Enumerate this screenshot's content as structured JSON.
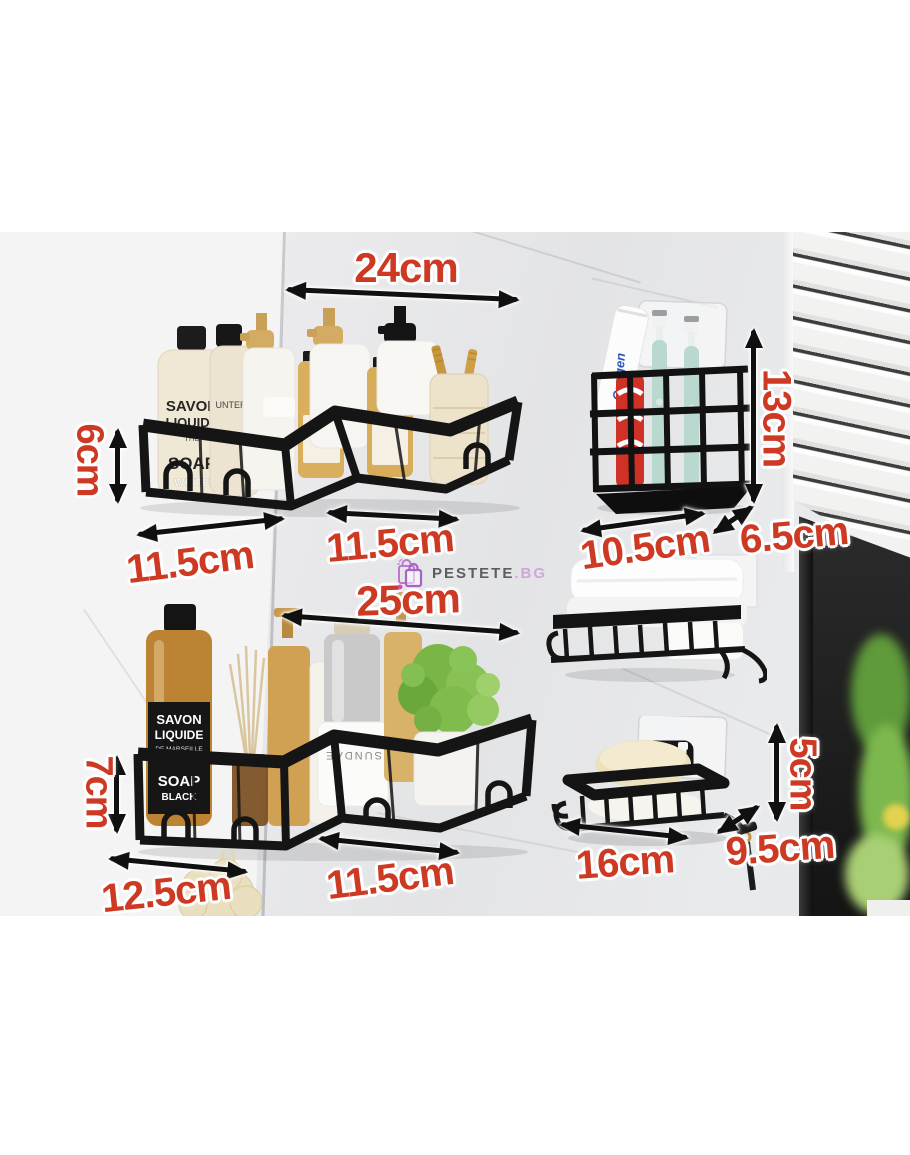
{
  "watermark": {
    "brand": "PESTETE",
    "suffix": ".BG"
  },
  "dimensions": {
    "upper_width": "24cm",
    "upper_height": "6cm",
    "upper_left_depth": "11.5cm",
    "upper_right_depth": "11.5cm",
    "holder_width": "10.5cm",
    "holder_depth": "6.5cm",
    "holder_height": "13cm",
    "lower_width": "25cm",
    "lower_height": "7cm",
    "lower_left_depth": "12.5cm",
    "lower_right_depth": "11.5cm",
    "dish_width": "16cm",
    "dish_depth": "9.5cm",
    "dish_height": "5cm"
  },
  "products": {
    "upper_bottle": {
      "line1": "SAVON",
      "line2": "LIQUIDE",
      "line3": "THE",
      "line4": "SOAP",
      "line5": "WHITE"
    },
    "upper_bottle2_text": "UNTER ⊕",
    "lower_bottle": {
      "line1": "SAVON",
      "line2": "LIQUIDE",
      "line3": "DE MARSEILLE",
      "line4": "SOAP",
      "line5": "BLACK"
    },
    "cup_text": "SUNDAE",
    "toothpaste_text": "Oxygen"
  },
  "colors": {
    "annotation_red": "#cd3922",
    "arrow_black": "#101010",
    "shelf_black": "#151515",
    "watermark_purple": "#a55cc5",
    "watermark_gray": "#55555a"
  }
}
